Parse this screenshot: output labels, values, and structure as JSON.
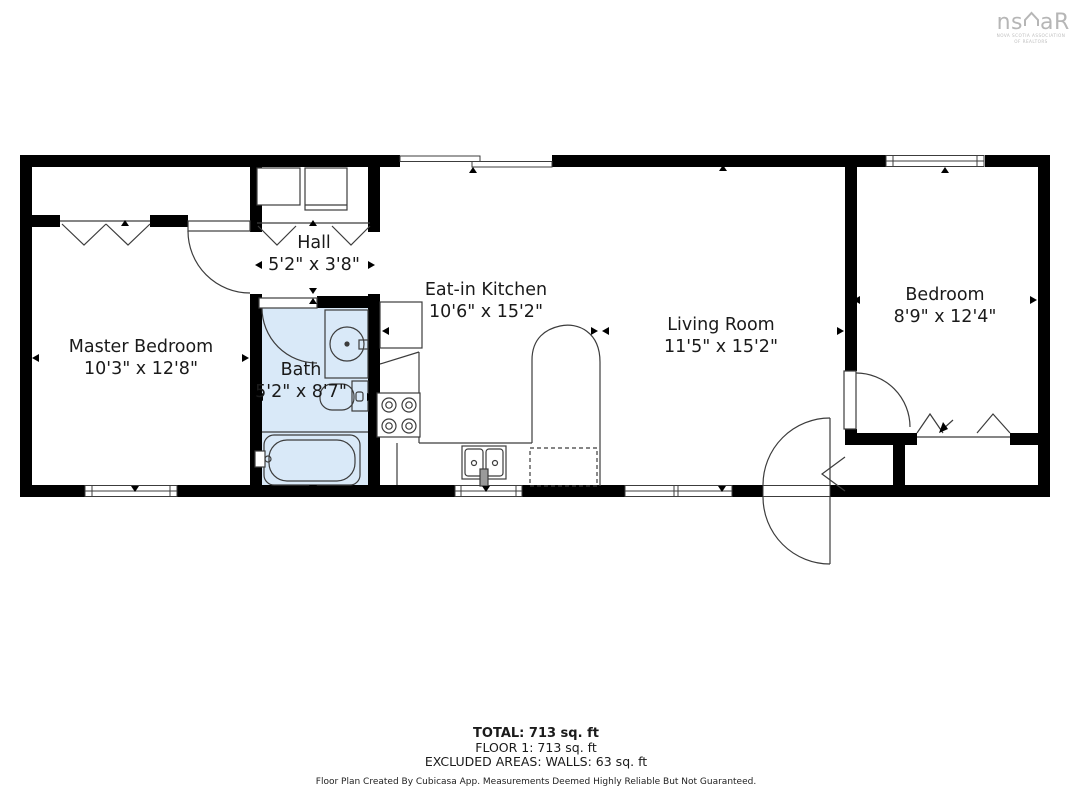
{
  "logo": {
    "brand_left": "ns",
    "brand_right": "aR",
    "caption_line1": "NOVA SCOTIA ASSOCIATION",
    "caption_line2": "OF REALTORS"
  },
  "rooms": [
    {
      "name": "Master Bedroom",
      "dimensions": "10'3\" x 12'8\""
    },
    {
      "name": "Hall",
      "dimensions": "5'2\" x 3'8\""
    },
    {
      "name": "Bath",
      "dimensions": "5'2\" x 8'7\""
    },
    {
      "name": "Eat-in Kitchen",
      "dimensions": "10'6\" x 15'2\""
    },
    {
      "name": "Living Room",
      "dimensions": "11'5\" x 15'2\""
    },
    {
      "name": "Bedroom",
      "dimensions": "8'9\" x 12'4\""
    }
  ],
  "summary": {
    "total": "TOTAL: 713 sq. ft",
    "floor": "FLOOR 1: 713 sq. ft",
    "excluded": "EXCLUDED AREAS: WALLS: 63 sq. ft"
  },
  "credit": "Floor Plan Created By Cubicasa App. Measurements Deemed Highly Reliable But Not Guaranteed.",
  "colors": {
    "wall": "#000000",
    "bath_fill": "#d9e9f8",
    "fixture_line": "#3c3c3c",
    "background": "#ffffff"
  }
}
